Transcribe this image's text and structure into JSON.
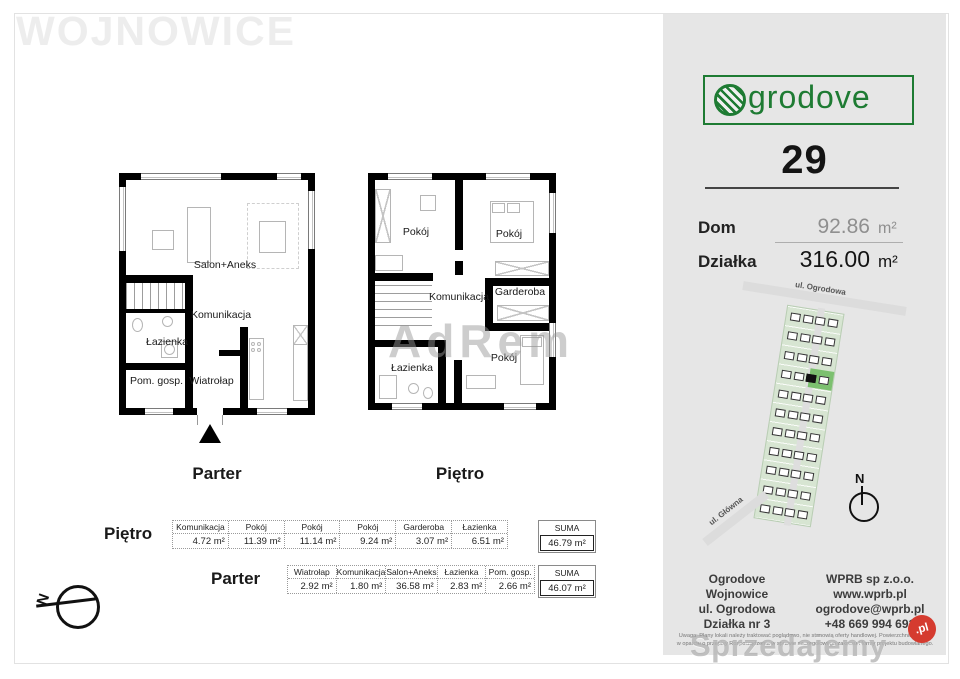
{
  "watermarks": {
    "location": "WOJNOWICE",
    "agency": "AdRem",
    "portal": "Sprzedajemy",
    "portal_tld": ".pl"
  },
  "floorplans": {
    "parter": {
      "caption": "Parter",
      "rooms": {
        "salon": "Salon+Aneks",
        "komunikacja": "Komunikacja",
        "lazienka": "Łazienka",
        "pom_gosp": "Pom. gosp.",
        "wiatrolap": "Wiatrołap"
      }
    },
    "pietro": {
      "caption": "Piętro",
      "rooms": {
        "pokoj1": "Pokój",
        "pokoj2": "Pokój",
        "komunikacja": "Komunikacja",
        "garderoba": "Garderoba",
        "pokoj3": "Pokój",
        "lazienka": "Łazienka"
      }
    }
  },
  "area_tables": [
    {
      "floor_label": "Piętro",
      "columns": [
        {
          "name": "Komunikacja",
          "value": "4.72 m²"
        },
        {
          "name": "Pokój",
          "value": "11.39 m²"
        },
        {
          "name": "Pokój",
          "value": "11.14 m²"
        },
        {
          "name": "Pokój",
          "value": "9.24 m²"
        },
        {
          "name": "Garderoba",
          "value": "3.07 m²"
        },
        {
          "name": "Łazienka",
          "value": "6.51 m²"
        }
      ],
      "suma_label": "SUMA",
      "suma_value": "46.79 m²"
    },
    {
      "floor_label": "Parter",
      "columns": [
        {
          "name": "Wiatrołap",
          "value": "2.92 m²"
        },
        {
          "name": "Komunikacja",
          "value": "1.80 m²"
        },
        {
          "name": "Salon+Aneks",
          "value": "36.58 m²"
        },
        {
          "name": "Łazienka",
          "value": "2.83 m²"
        },
        {
          "name": "Pom. gosp.",
          "value": "2.66 m²"
        }
      ],
      "suma_label": "SUMA",
      "suma_value": "46.07 m²"
    }
  ],
  "sidebar": {
    "logo_text": "grodove",
    "unit_number": "29",
    "specs": {
      "dom_label": "Dom",
      "dom_value": "92.86",
      "dom_unit": "m²",
      "dzialka_label": "Działka",
      "dzialka_value": "316.00",
      "dzialka_unit": "m²"
    },
    "map": {
      "street_top": "ul. Ogrodowa",
      "street_bottom": "ul. Główna",
      "compass_n": "N"
    },
    "contact_left": [
      "Ogrodove",
      "Wojnowice",
      "ul. Ogrodowa",
      "Działka nr 3"
    ],
    "contact_right": [
      "WPRB sp z.o.o.",
      "www.wprb.pl",
      "ogrodove@wprb.pl",
      "+48 669 994 691"
    ],
    "disclaimer": "Uwaga: Plany lokali należy traktować poglądowo, nie stanowią oferty handlowej. Powierzchnie liczone w oparciu o przepisy Rozporządzenia w sprawie szczegółowego zakresu i formy projektu budowlanego."
  },
  "compass": {
    "label": "N"
  },
  "colors": {
    "brand_green": "#1e7b33",
    "map_plot": "#d7e5d2",
    "map_plot_highlight": "#7cc06f",
    "portal_red": "#d53b2f",
    "sidebar_bg": "#e6e6e6"
  }
}
